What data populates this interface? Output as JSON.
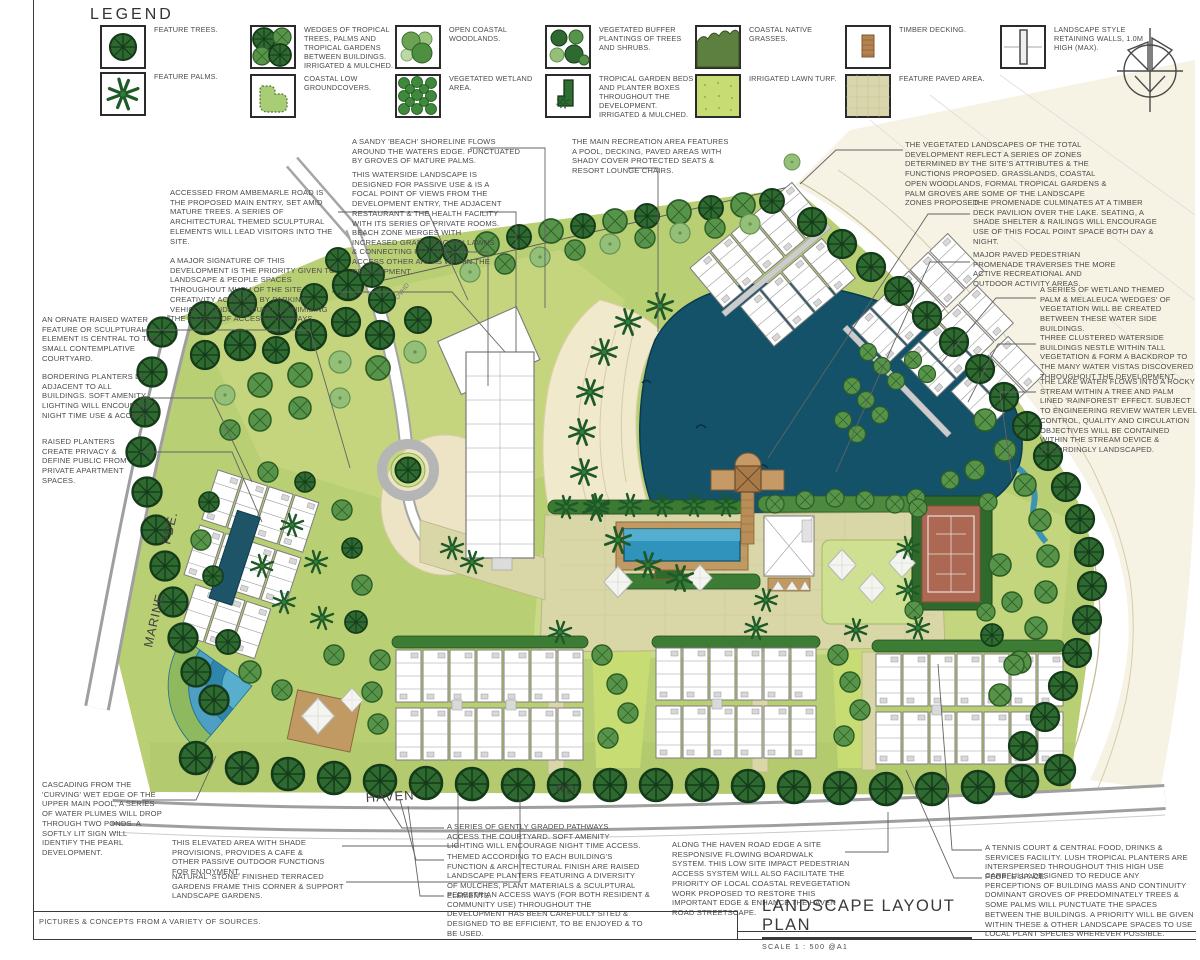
{
  "legend": {
    "title": "LEGEND",
    "items": [
      {
        "id": "feature-trees",
        "label": "FEATURE TREES."
      },
      {
        "id": "feature-palms",
        "label": "FEATURE PALMS."
      },
      {
        "id": "tropical-wedges",
        "label": "WEDGES OF TROPICAL TREES, PALMS AND TROPICAL GARDENS BETWEEN BUILDINGS. IRRIGATED & MULCHED."
      },
      {
        "id": "coastal-low-groundcovers",
        "label": "COASTAL LOW GROUNDCOVERS."
      },
      {
        "id": "open-coastal-woodlands",
        "label": "OPEN COASTAL WOODLANDS."
      },
      {
        "id": "vegetated-wetland-area",
        "label": "VEGETATED WETLAND AREA."
      },
      {
        "id": "vegetated-buffer",
        "label": "VEGETATED BUFFER PLANTINGS OF TREES AND SHRUBS."
      },
      {
        "id": "tropical-garden-beds",
        "label": "TROPICAL GARDEN BEDS AND PLANTER BOXES THROUGHOUT THE DEVELOPMENT. IRRIGATED & MULCHED."
      },
      {
        "id": "coastal-native-grasses",
        "label": "COASTAL NATIVE GRASSES."
      },
      {
        "id": "irrigated-lawn-turf",
        "label": "IRRIGATED LAWN TURF."
      },
      {
        "id": "timber-decking",
        "label": "TIMBER DECKING."
      },
      {
        "id": "feature-paved-area",
        "label": "FEATURE PAVED AREA."
      },
      {
        "id": "retaining-walls",
        "label": "LANDSCAPE STYLE RETAINING WALLS, 1.0M HIGH (MAX)."
      }
    ]
  },
  "plan_labels": {
    "marine": "MARINE",
    "pde": "PDE.",
    "haven": "HAVEN",
    "rd": "RD.",
    "ovhd": "OVHD"
  },
  "annotations": [
    {
      "id": "main-entry",
      "text": "ACCESSED FROM AMBEMARLE ROAD IS THE PROPOSED MAIN ENTRY, SET AMID MATURE TREES. A SERIES OF ARCHITECTURAL THEMED SCULPTURAL ELEMENTS WILL LEAD VISITORS INTO THE SITE."
    },
    {
      "id": "major-signature",
      "text": "A MAJOR SIGNATURE OF THIS DEVELOPMENT IS THE PRIORITY GIVEN TO LANDSCAPE & PEOPLE SPACES THROUGHOUT MUCH OF THE SITE, CREATIVITY ACHIEVED BY PARKING VEHICLES UNDERGROUND & MINIMISING THE EXTENT OF ACCESS ROADWAYS."
    },
    {
      "id": "water-feature-courtyard",
      "text": "AN ORNATE RAISED WATER FEATURE OR SCULPTURAL ELEMENT IS CENTRAL TO THIS SMALL CONTEMPLATIVE COURTYARD."
    },
    {
      "id": "bordering-planters",
      "text": "BORDERING PLANTERS LIE ADJACENT TO ALL BUILDINGS. SOFT AMENITY LIGHTING WILL ENCOURAGE NIGHT TIME USE & ACCESS."
    },
    {
      "id": "raised-planters",
      "text": "RAISED PLANTERS CREATE PRIVACY & DEFINE PUBLIC FROM PRIVATE APARTMENT SPACES."
    },
    {
      "id": "cascading-ponds",
      "text": "CASCADING FROM THE 'CURVING' WET EDGE OF THE UPPER MAIN POOL, A SERIES OF WATER PLUMES WILL DROP THROUGH TWO PONDS. A SOFTLY LIT SIGN WILL IDENTIFY THE PEARL DEVELOPMENT."
    },
    {
      "id": "sandy-beach",
      "text": "A SANDY 'BEACH' SHORELINE FLOWS AROUND THE WATERS EDGE. PUNCTUATED BY GROVES OF MATURE PALMS."
    },
    {
      "id": "waterside-landscape",
      "text": "THIS WATERSIDE LANDSCAPE IS DESIGNED FOR PASSIVE USE & IS A FOCAL POINT OF VIEWS FROM THE DEVELOPMENT ENTRY, THE ADJACENT RESTAURANT & THE HEALTH FACILITY WITH ITS SERIES OF PRIVATE ROOMS."
    },
    {
      "id": "beach-zone",
      "text": "BEACH ZONE MERGES WITH INCREASED GRADE TO OPEN LAWNS & CONNECTING PATHWAYS TO ACCESS OTHER AREAS WITHIN THE DEVELOPMENT."
    },
    {
      "id": "main-recreation-area",
      "text": "THE MAIN RECREATION AREA FEATURES A POOL, DECKING, PAVED AREAS WITH SHADY COVER PROTECTED SEATS & RESORT LOUNGE CHAIRS."
    },
    {
      "id": "vegetated-zones",
      "text": "THE VEGETATED LANDSCAPES OF THE TOTAL DEVELOPMENT REFLECT A SERIES OF ZONES DETERMINED BY THE SITE'S ATTRIBUTES & THE FUNCTIONS PROPOSED. GRASSLANDS, COASTAL OPEN WOODLANDS, FORMAL TROPICAL GARDENS & PALM GROVES ARE SOME OF THE LANDSCAPE ZONES PROPOSED."
    },
    {
      "id": "promenade-pavilion",
      "text": "THE PROMENADE CULMINATES AT A TIMBER DECK PAVILION OVER THE LAKE. SEATING, A SHADE SHELTER & RAILINGS WILL ENCOURAGE USE OF THIS FOCAL POINT SPACE BOTH DAY & NIGHT."
    },
    {
      "id": "paved-promenade",
      "text": "MAJOR PAVED PEDESTRIAN PROMENADE TRAVERSES THE MORE ACTIVE RECREATIONAL AND OUTDOOR ACTIVITY AREAS."
    },
    {
      "id": "wetland-wedges",
      "text": "A SERIES OF WETLAND THEMED PALM & MELALEUCA 'WEDGES' OF VEGETATION WILL BE CREATED BETWEEN THESE WATER SIDE BUILDINGS."
    },
    {
      "id": "clustered-buildings",
      "text": "THREE CLUSTERED WATERSIDE BUILDINGS NESTLE WITHIN TALL VEGETATION & FORM A BACKDROP TO THE MANY WATER VISTAS DISCOVERED THROUGHOUT THE DEVELOPMENT."
    },
    {
      "id": "rocky-stream",
      "text": "THE LAKE WATER FLOWS INTO A ROCKY STREAM WITHIN A TREE AND PALM LINED 'RAINFOREST' EFFECT. SUBJECT TO ENGINEERING REVIEW WATER LEVEL CONTROL, QUALITY AND CIRCULATION OBJECTIVES WILL BE CONTAINED WITHIN THE STREAM DEVICE & ACCORDINGLY LANDSCAPED."
    },
    {
      "id": "elevated-cafe",
      "text": "THIS ELEVATED AREA WITH SHADE PROVISIONS, PROVIDES A CAFE & OTHER PASSIVE OUTDOOR FUNCTIONS FOR ENJOYMENT."
    },
    {
      "id": "stone-terraces",
      "text": "NATURAL 'STONE' FINISHED TERRACED GARDENS FRAME THIS CORNER & SUPPORT LANDSCAPE GARDENS."
    },
    {
      "id": "graded-pathways",
      "text": "A SERIES OF GENTLY GRADED PATHWAYS ACCESS THE COURTYARD. SOFT AMENITY LIGHTING WILL ENCOURAGE NIGHT TIME ACCESS."
    },
    {
      "id": "themed-planters",
      "text": "THEMED ACCORDING TO EACH BUILDING'S FUNCTION & ARCHITECTURAL FINISH ARE RAISED LANDSCAPE PLANTERS FEATURING A DIVERSITY OF MULCHES, PLANT MATERIALS & SCULPTURAL ELEMENTS."
    },
    {
      "id": "pedestrian-access",
      "text": "PEDESTRIAN ACCESS WAYS (FOR BOTH RESIDENT & COMMUNITY USE) THROUGHOUT THE DEVELOPMENT HAS BEEN CAREFULLY SITED & DESIGNED TO BE EFFICIENT, TO BE ENJOYED & TO BE USED."
    },
    {
      "id": "haven-boardwalk",
      "text": "ALONG THE HAVEN ROAD EDGE A SITE RESPONSIVE FLOWING BOARDWALK SYSTEM. THIS LOW SITE IMPACT PEDESTRIAN ACCESS SYSTEM WILL ALSO FACILITATE THE PRIORITY OF LOCAL COASTAL REVEGETATION WORK PROPOSED TO RESTORE THIS IMPORTANT EDGE & ENHANCE THE HAVEN ROAD STREETSCAPE."
    },
    {
      "id": "tennis-facility",
      "text": "A TENNIS COURT & CENTRAL FOOD, DRINKS & SERVICES FACILITY. LUSH TROPICAL PLANTERS ARE INTERSPERSED THROUGHOUT THIS HIGH USE PEOPLE SPACE."
    },
    {
      "id": "building-mass",
      "text": "CAREFULLY DESIGNED TO REDUCE ANY PERCEPTIONS OF BUILDING MASS AND CONTINUITY DOMINANT GROVES OF PREDOMINATELY TREES & SOME PALMS WILL PUNCTUATE THE SPACES BETWEEN THE BUILDINGS. A PRIORITY WILL BE GIVEN WITHIN THESE & OTHER LANDSCAPE SPACES TO USE LOCAL PLANT SPECIES WHEREVER POSSIBLE."
    }
  ],
  "title_block": {
    "title": "LANDSCAPE LAYOUT PLAN",
    "scale": "SCALE 1 : 500   @A1"
  },
  "footer_note": "PICTURES & CONCEPTS FROM A VARIETY OF SOURCES.",
  "colors": {
    "lake": "#14526a",
    "pool": "#2f93bc",
    "sand": "#f1e9cc",
    "lawn": "#b9cf74",
    "bright_lawn": "#c7dc72",
    "dark_tree": "#2e6a30",
    "mid_tree": "#57944a",
    "timber": "#b5834f",
    "paved": "#d9d6ad",
    "tennis_court": "#ad6853",
    "road_casing": "#9f9f9f"
  }
}
